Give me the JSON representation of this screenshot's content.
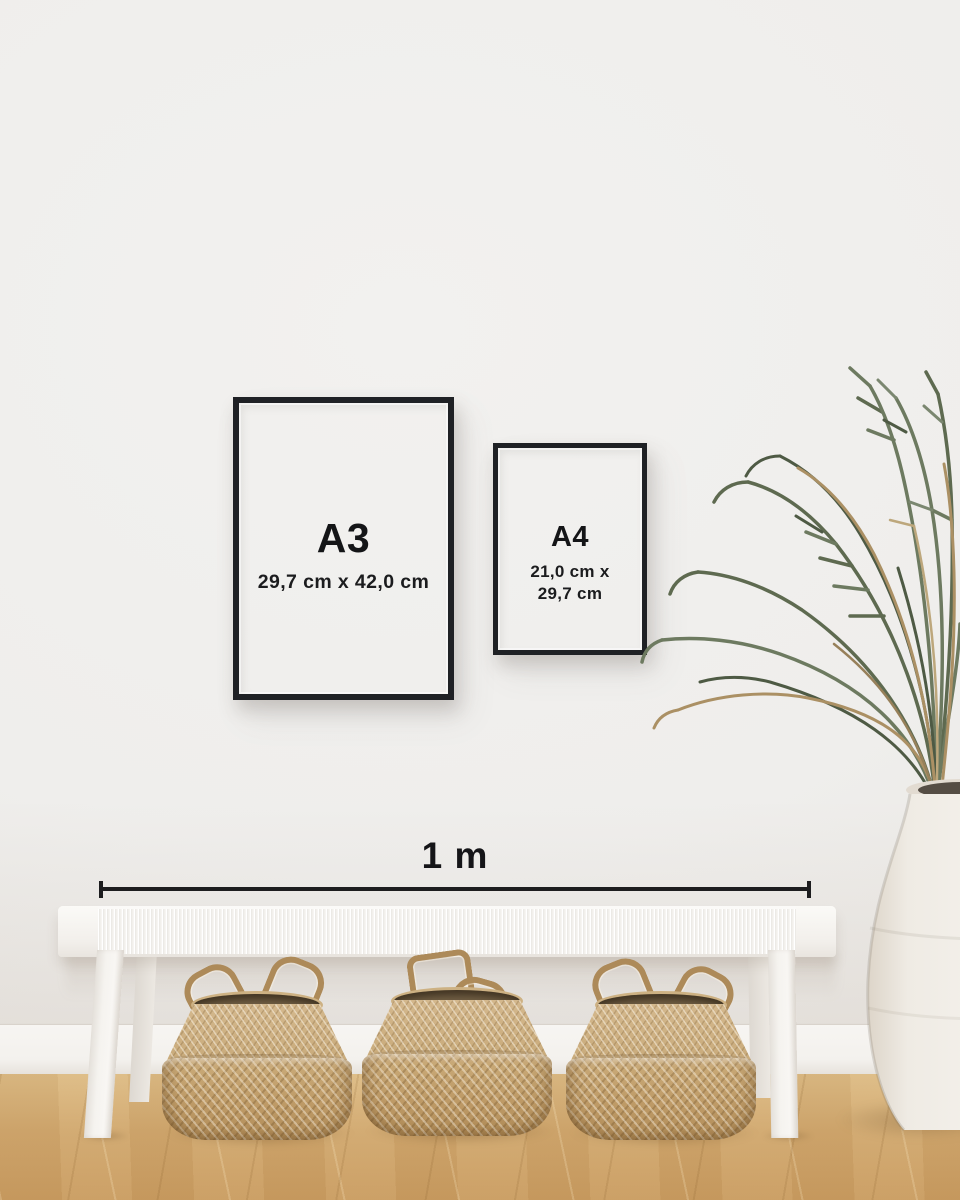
{
  "frames": {
    "a3": {
      "label": "A3",
      "dimensions": "29,7 cm x 42,0 cm"
    },
    "a4": {
      "label": "A4",
      "dimensions_line1": "21,0 cm x",
      "dimensions_line2": "29,7 cm"
    }
  },
  "scale_bar": {
    "label": "1 m"
  },
  "colors": {
    "wall": "#efeeec",
    "baseboard": "#f5f3f0",
    "floor_wood": "#cda56c",
    "frame_border": "#1f2125",
    "frame_paper": "#e9e7e5",
    "label_text": "#141517",
    "bench_white": "#f6f4f1",
    "basket_tan": "#c5a678",
    "plant_green": "#616d53",
    "plant_dried": "#ab9064",
    "vase_white": "#efebe4"
  }
}
